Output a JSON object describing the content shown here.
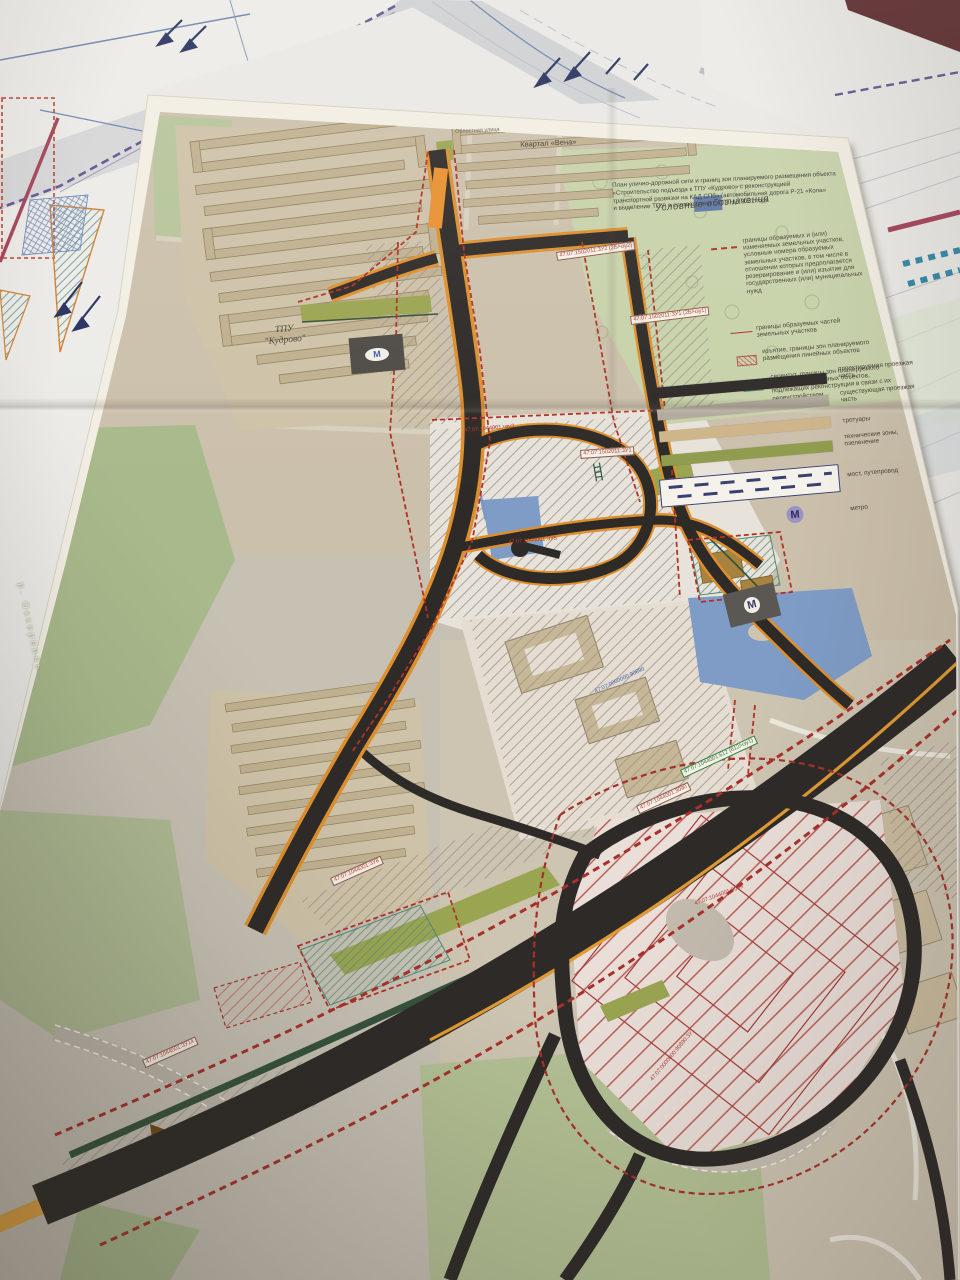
{
  "scene_description": "Photo of a printed urban road-planning map (Kudrovo transport hub, KAD interchange) lying on top of other drawings on a dark table",
  "colors": {
    "boundary_red": "#b23226",
    "road_black": "#2d2a27",
    "road_orange": "#e0922e",
    "existing_highway_orange": "#e2a440",
    "water_blue": "#7f9cc6",
    "park_green": "#c8d3aa",
    "tech_zone_green": "#8f9c4d",
    "metro_lavender": "#9a93c4",
    "table_maroon": "#5a2629"
  },
  "title_block": {
    "lines": [
      "План улично-дорожной сети и границ зон планируемого размещения объекта",
      "«Строительство подъезда к ТПУ «Кудрово» с реконструкцией",
      "транспортной развязки на КАД СПб» (автомобильная дорога Р-21 «Кола»",
      "и выделение ТПУ) в соответствии с ППТ до 2031 года"
    ]
  },
  "legend": {
    "title": "Условные обозначения",
    "items": [
      {
        "symbol": "red-dashed-boundary",
        "label": "границы образуемых и (или) изменяемых земельных участков, условные номера образуемых земельных участков, в том числе в отношении которых предполагается резервирование и (или) изъятие для государственных (или) муниципальных нужд"
      },
      {
        "symbol": "red-line",
        "label": "границы образуемых частей земельных участков"
      },
      {
        "symbol": "red-hatch",
        "label": "изъятие, границы зон планируемого размещения линейных объектов"
      },
      {
        "symbol": "teal-hatch",
        "label": "сервитут, границы зон планируемого размещения линейных объектов, подлежащих реконструкции в связи с их переустройством"
      },
      {
        "symbol": "black-bar",
        "label": "проектируемая проезжая часть"
      },
      {
        "symbol": "gray-bar",
        "label": "существующая проезжая часть"
      },
      {
        "symbol": "tan-bar",
        "label": "тротуары"
      },
      {
        "symbol": "green-bar",
        "label": "технические зоны, озеленение"
      },
      {
        "symbol": "dashed-box",
        "label": "мост, путепровод"
      },
      {
        "symbol": "metro-m",
        "label": "метро"
      }
    ]
  },
  "map_labels": {
    "tpu_line1": "ТПУ",
    "tpu_line2": "\"Кудрово\"",
    "kvartal": "Квартал «Вена»",
    "street": "Областная улица",
    "river": "р. Оккервиль",
    "metro_m": "М"
  },
  "cadastral": [
    {
      "text": "47:07:1502011:ЗУ1 (2Б/чзу1)"
    },
    {
      "text": "47:07:1502011:ЗУ2 (2Б/чзу2)"
    },
    {
      "text": "47:07:1044001:чзу3"
    },
    {
      "text": "47:07:1044001:ЗУ5"
    },
    {
      "text": "47:07:1044001:612 (612/чзу1)"
    },
    {
      "text": "47:07:1044001:3090"
    },
    {
      "text": "47:07:0000000:90890"
    },
    {
      "text": "47:07:1044001:ЗУ14"
    },
    {
      "text": "47:07:1044001:3089"
    },
    {
      "text": "47:07:0000000:90890:ЗУ1"
    },
    {
      "text": "47:07:1044001:ЗУ8"
    },
    {
      "text": "47:07:1502011:ЗУ1"
    }
  ]
}
